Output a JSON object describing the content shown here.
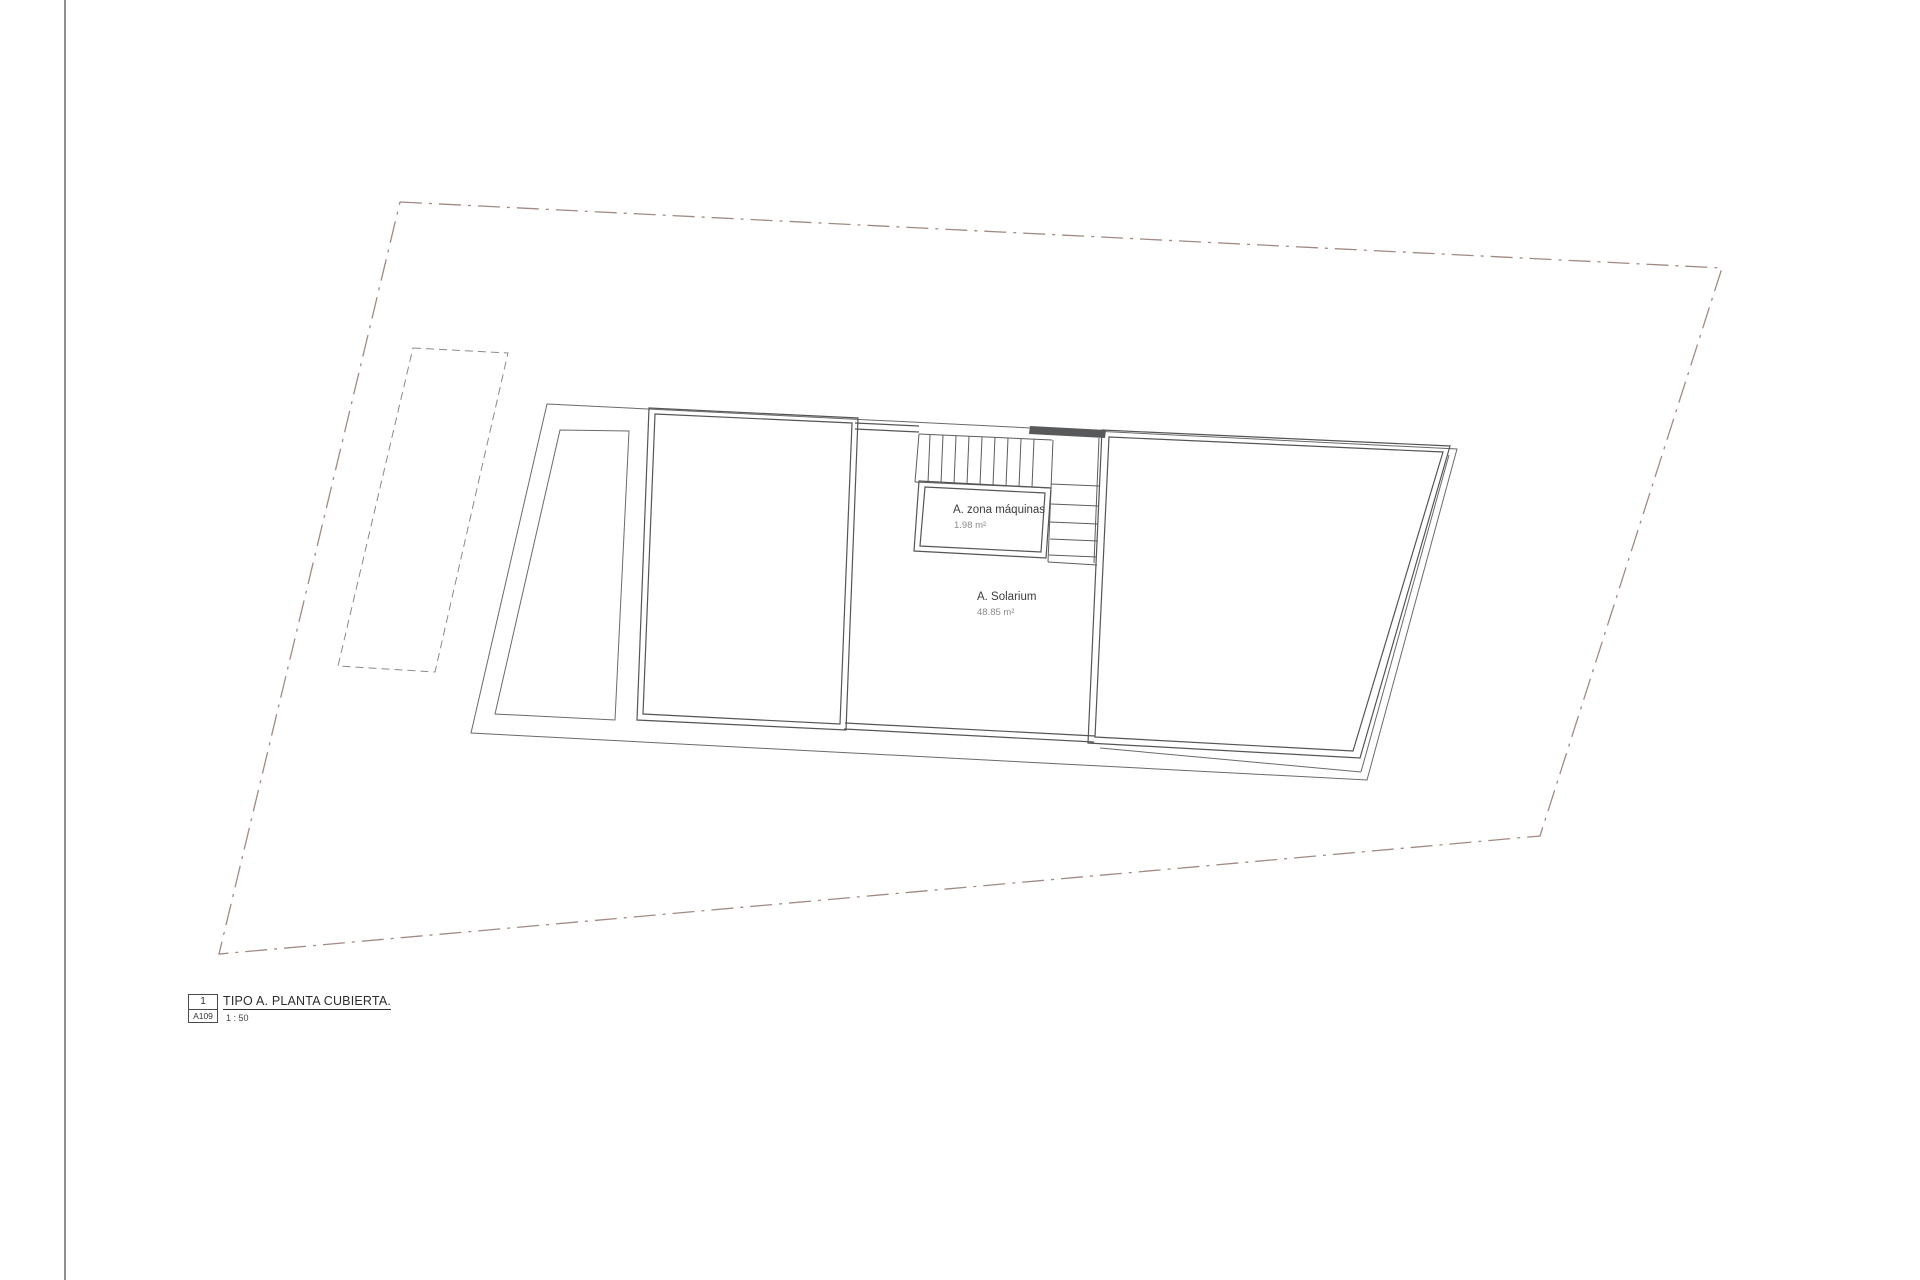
{
  "sheet": {
    "title_block": {
      "detail_number": "1",
      "sheet_number": "A109",
      "title": "TIPO A. PLANTA CUBIERTA.",
      "scale": "1 : 50"
    },
    "rooms": {
      "machine_room": {
        "name": "A. zona máquinas",
        "area": "1.98 m²"
      },
      "solarium": {
        "name": "A. Solarium",
        "area": "48.85 m²"
      }
    },
    "colors": {
      "roof_green": "#e9ecd8",
      "dark_wall": "#58595b",
      "wall_line": "#555555",
      "boundary_line": "#a08a84",
      "text": "#3c3c3c",
      "muted_text": "#8c8c8c",
      "paper": "#ffffff"
    }
  }
}
